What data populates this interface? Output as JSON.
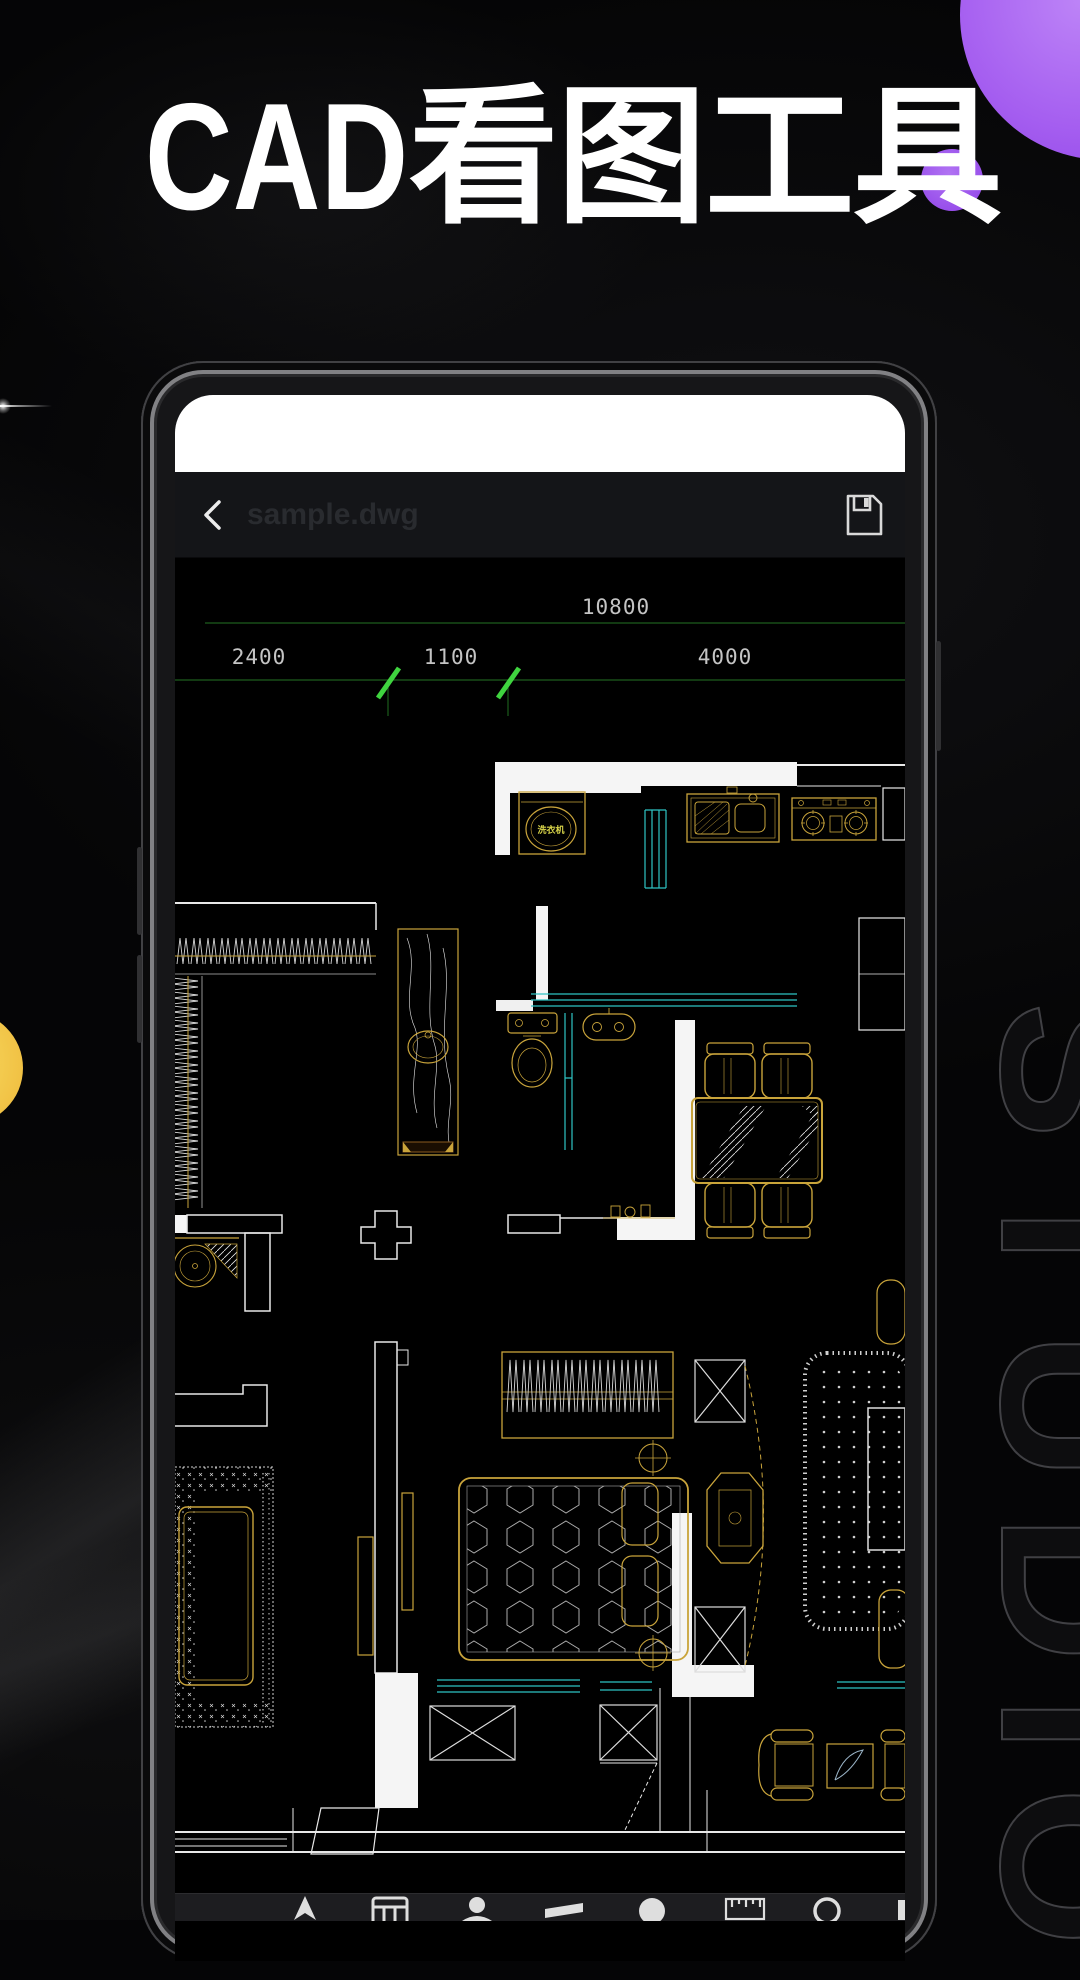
{
  "hero": {
    "title_latin": "CAD",
    "title_cjk": "看图工具",
    "watermark": "STUDIO"
  },
  "phone": {
    "toolbar": {
      "filename": "sample.dwg",
      "back_icon": "chevron-left",
      "save_icon": "floppy-disk"
    },
    "cad": {
      "dims": {
        "total": "10800",
        "seg1": "2400",
        "seg2": "1100",
        "seg3": "4000"
      },
      "labels": {
        "washer": "洗衣机"
      },
      "colors": {
        "wall": "#f0f0f0",
        "fixture": "#c9a43b",
        "glass": "#2ec4c4",
        "dim_line": "#1c5c1c",
        "tick": "#3fd43f",
        "dim_text": "#c4c4c4",
        "canvas": "#000000"
      }
    },
    "bottom_toolbar": {
      "icons": [
        "navigate-icon",
        "grid-icon",
        "user-icon",
        "layers-icon",
        "circle-icon",
        "ruler-icon",
        "gear-icon",
        "edge-partial-icon"
      ]
    }
  },
  "decor": {
    "purple_large": "#a55ef0",
    "purple_small": "#9a4ee9",
    "yellow": "#f2c945",
    "studio_stroke": "#404044"
  }
}
